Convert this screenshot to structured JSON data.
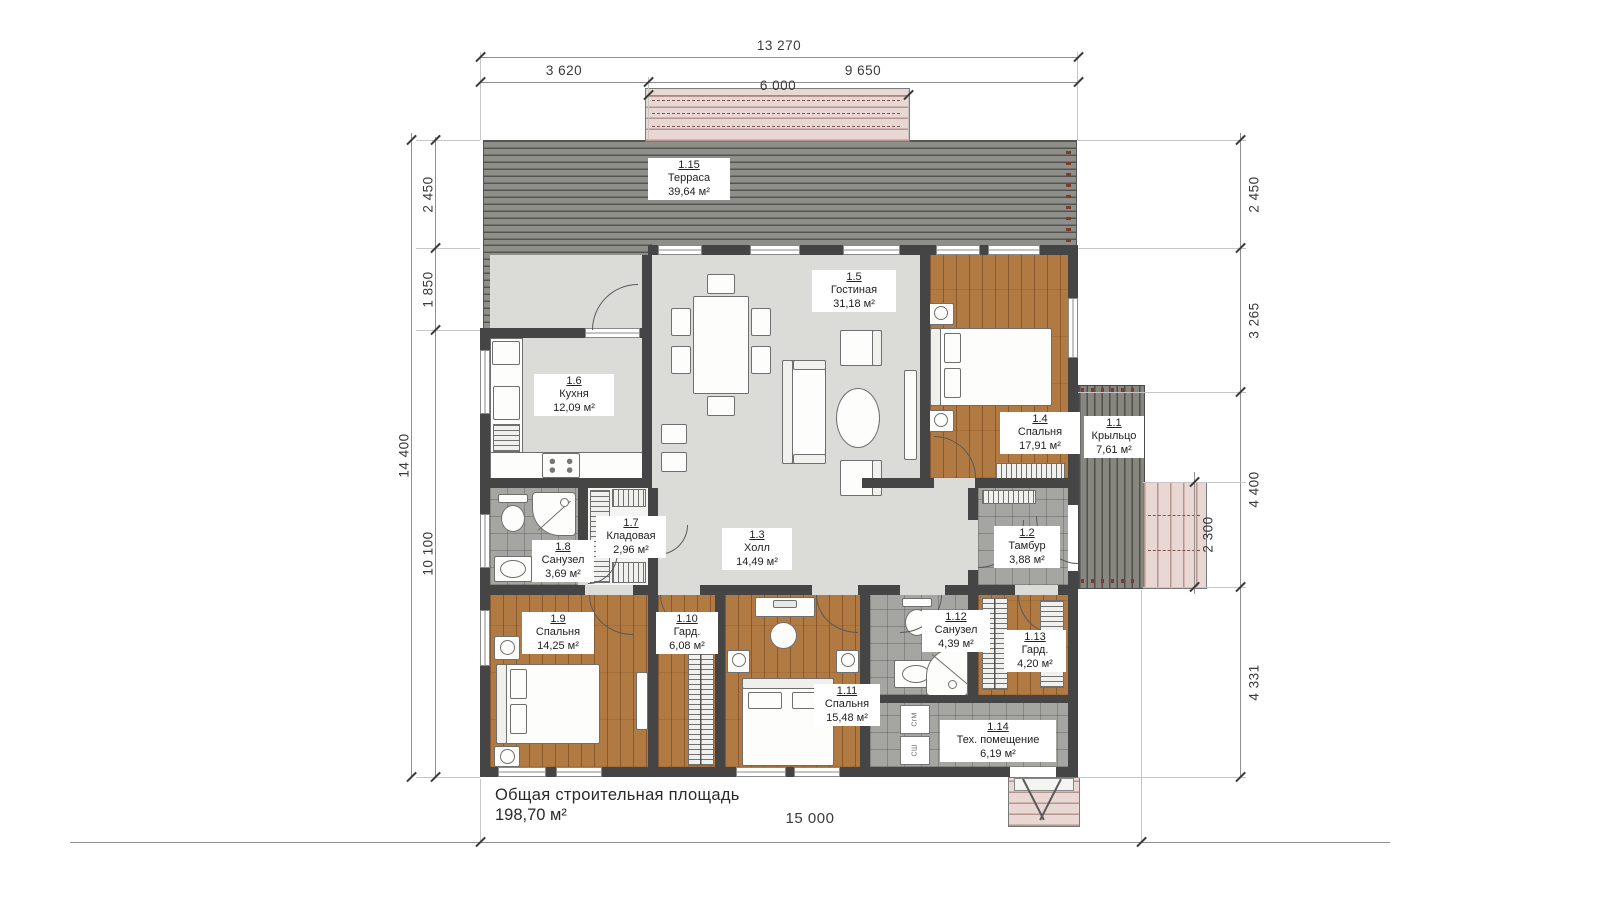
{
  "title": {
    "line1": "Общая строительная площадь",
    "line2": "198,70 м²"
  },
  "rooms": [
    {
      "number": "1.1",
      "name": "Крыльцо",
      "area": "7,61 м²"
    },
    {
      "number": "1.2",
      "name": "Тамбур",
      "area": "3,88 м²"
    },
    {
      "number": "1.3",
      "name": "Холл",
      "area": "14,49 м²"
    },
    {
      "number": "1.4",
      "name": "Спальня",
      "area": "17,91 м²"
    },
    {
      "number": "1.5",
      "name": "Гостиная",
      "area": "31,18 м²"
    },
    {
      "number": "1.6",
      "name": "Кухня",
      "area": "12,09 м²"
    },
    {
      "number": "1.7",
      "name": "Кладовая",
      "area": "2,96 м²"
    },
    {
      "number": "1.8",
      "name": "Санузел",
      "area": "3,69 м²"
    },
    {
      "number": "1.9",
      "name": "Спальня",
      "area": "14,25 м²"
    },
    {
      "number": "1.10",
      "name": "Гард.",
      "area": "6,08 м²"
    },
    {
      "number": "1.11",
      "name": "Спальня",
      "area": "15,48 м²"
    },
    {
      "number": "1.12",
      "name": "Санузел",
      "area": "4,39 м²"
    },
    {
      "number": "1.13",
      "name": "Гард.",
      "area": "4,20 м²"
    },
    {
      "number": "1.14",
      "name": "Тех. помещение",
      "area": "6,19 м²"
    },
    {
      "number": "1.15",
      "name": "Терраса",
      "area": "39,64 м²"
    }
  ],
  "dims": {
    "total_width": "13 270",
    "left_section": "3 620",
    "right_section": "9 650",
    "pergola": "6 000",
    "total_height": "14 400",
    "terrace_depth": "2 450",
    "kitchen_offset": "1 850",
    "body_height": "10 100",
    "right_top": "2 450",
    "right_upper": "3 265",
    "right_mid": "4 400",
    "porch_steps": "2 300",
    "right_bottom": "4 331",
    "total_bottom": "15 000"
  },
  "appliances": {
    "washer": "СгМ",
    "dryer": "СШ"
  }
}
